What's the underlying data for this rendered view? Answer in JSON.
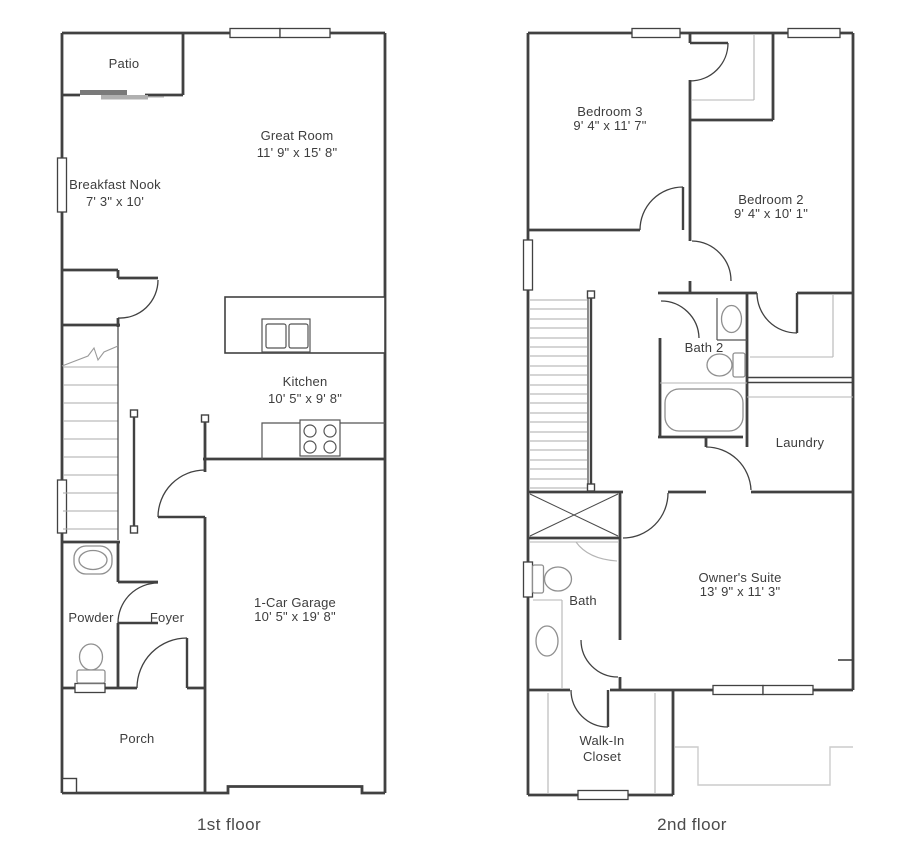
{
  "page": {
    "background": "#ffffff"
  },
  "colors": {
    "wall": "#414141",
    "fixture": "#8f8f8f",
    "light_detail": "#b5b5b5",
    "roof_outline": "#cccccc",
    "label_text": "#3d3d3d",
    "caption_text": "#4b4b4b"
  },
  "floors": [
    {
      "caption": "1st floor",
      "rooms": {
        "patio": {
          "label": "Patio"
        },
        "great_room": {
          "label": "Great Room",
          "dims": "11' 9\" x 15' 8\""
        },
        "breakfast_nook": {
          "label": "Breakfast Nook",
          "dims": "7' 3\" x 10'"
        },
        "kitchen": {
          "label": "Kitchen",
          "dims": "10' 5\" x 9' 8\""
        },
        "powder": {
          "label": "Powder"
        },
        "foyer": {
          "label": "Foyer"
        },
        "garage": {
          "label": "1-Car Garage",
          "dims": "10' 5\" x 19' 8\""
        },
        "porch": {
          "label": "Porch"
        }
      }
    },
    {
      "caption": "2nd floor",
      "rooms": {
        "bedroom3": {
          "label": "Bedroom 3",
          "dims": "9' 4\" x 11' 7\""
        },
        "bedroom2": {
          "label": "Bedroom 2",
          "dims": "9' 4\" x 10' 1\""
        },
        "bath2": {
          "label": "Bath 2"
        },
        "laundry": {
          "label": "Laundry"
        },
        "owners_suite": {
          "label": "Owner's Suite",
          "dims": "13' 9\" x 11' 3\""
        },
        "bath": {
          "label": "Bath"
        },
        "walk_in_closet": {
          "line1": "Walk-In",
          "line2": "Closet"
        }
      }
    }
  ]
}
